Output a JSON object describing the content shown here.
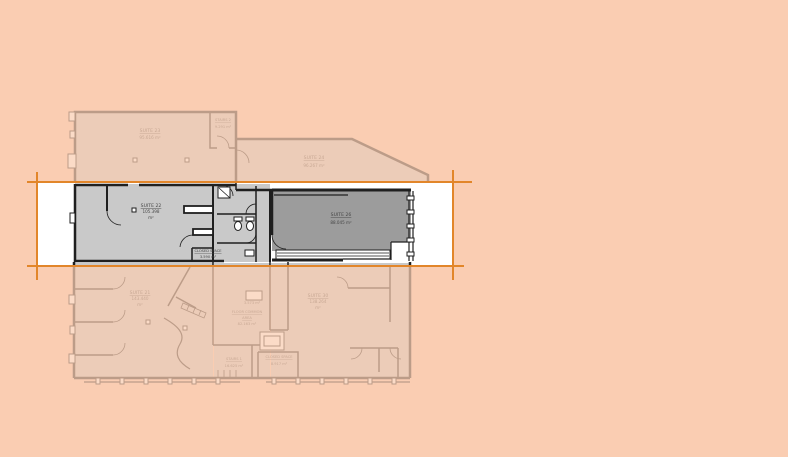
{
  "colors": {
    "background": "#FACDB2",
    "overlay": "#FACDB2",
    "overlay_opacity": "0.72",
    "guide_line": "#E2862A",
    "band_background": "#FFFFFF",
    "floor_light": "#C9C9C9",
    "floor_dark": "#9C9C9C",
    "wall": "#1F1F1F",
    "label_text": "#474747"
  },
  "floorplan": {
    "rooms": {
      "suite23": {
        "name": "SUITE 23",
        "area": "95.616 m²"
      },
      "stairs2": {
        "name": "STAIRS 2",
        "area": "9.291 m²"
      },
      "suite24": {
        "name": "SUITE 24",
        "area": "96.267 m²"
      },
      "suite22": {
        "name": "SUITE 22",
        "area_value": "105.398",
        "area_unit": "m²"
      },
      "closedSpaceA": {
        "name": "CLOSED SPACE",
        "area": "3.590 m²"
      },
      "suite26": {
        "name": "SUITE 26",
        "area": "88.045 m²"
      },
      "suite21": {
        "name": "SUITE 21",
        "area_value": "143.440",
        "area_unit": "m²"
      },
      "floorCommon": {
        "name_line1": "FLOOR COMMON",
        "name_line2": "AREA",
        "area": "82.163 m²"
      },
      "smallCloset": {
        "area": "3.573 m²"
      },
      "stairs1": {
        "name": "STAIRS 1",
        "area": "16.625 m²"
      },
      "closedSpaceB": {
        "name": "CLOSED SPACE",
        "area": "8.917 m²"
      },
      "suite30": {
        "name": "SUITE 30",
        "area_value": "138.264",
        "area_unit": "m²"
      }
    }
  }
}
